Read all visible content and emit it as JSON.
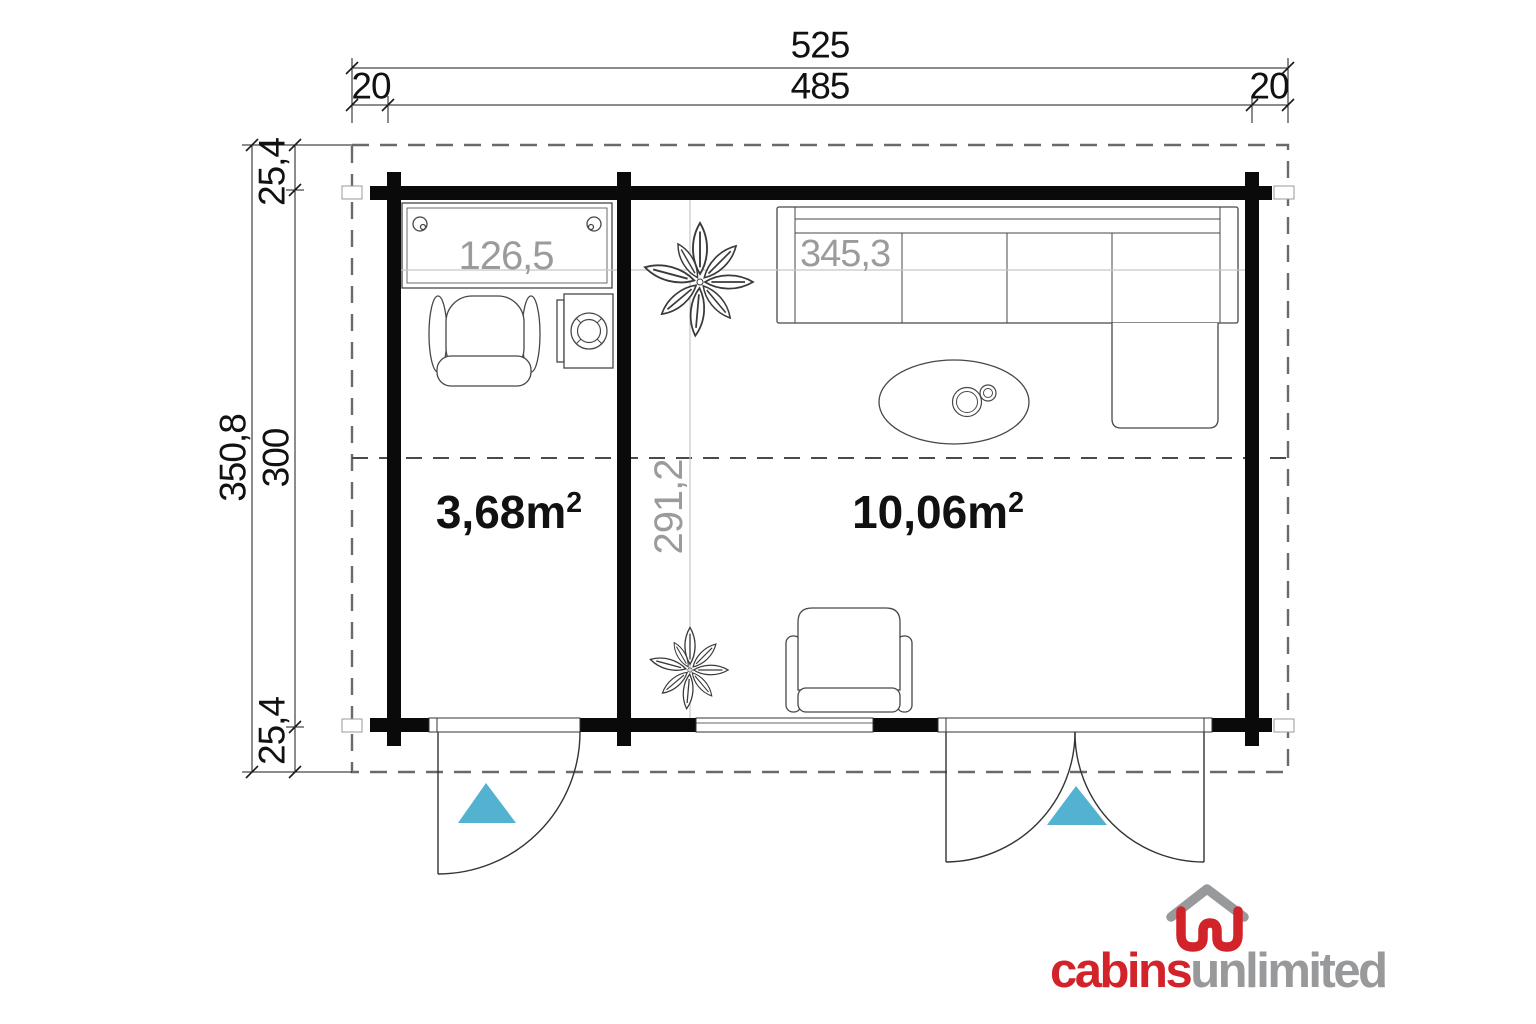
{
  "colors": {
    "accent": "#52b2d0",
    "logo-red": "#d2232a",
    "logo-gray": "#97999b",
    "dim-gray": "#9b9b9b",
    "ink": "#1a1a1a"
  },
  "dimensions_top": {
    "total": "525",
    "left": "20",
    "middle": "485",
    "right": "20"
  },
  "dimensions_left": {
    "total": "350,8",
    "top": "25,4",
    "middle": "300",
    "bottom": "25,4"
  },
  "rooms": {
    "small": {
      "area": "3,68m",
      "area_sup": "2",
      "desk_width": "126,5"
    },
    "large": {
      "area": "10,06m",
      "area_sup": "2",
      "sofa_width": "345,3",
      "room_depth": "291,2"
    }
  },
  "furniture": [
    {
      "name": "desk"
    },
    {
      "name": "office-chair"
    },
    {
      "name": "washing-machine"
    },
    {
      "name": "plant"
    },
    {
      "name": "corner-sofa"
    },
    {
      "name": "coffee-table"
    },
    {
      "name": "armchair"
    },
    {
      "name": "plant"
    }
  ],
  "doors": [
    {
      "name": "single-door"
    },
    {
      "name": "double-door"
    }
  ],
  "logo": {
    "part1": "cabins",
    "part2": "unlimited"
  }
}
